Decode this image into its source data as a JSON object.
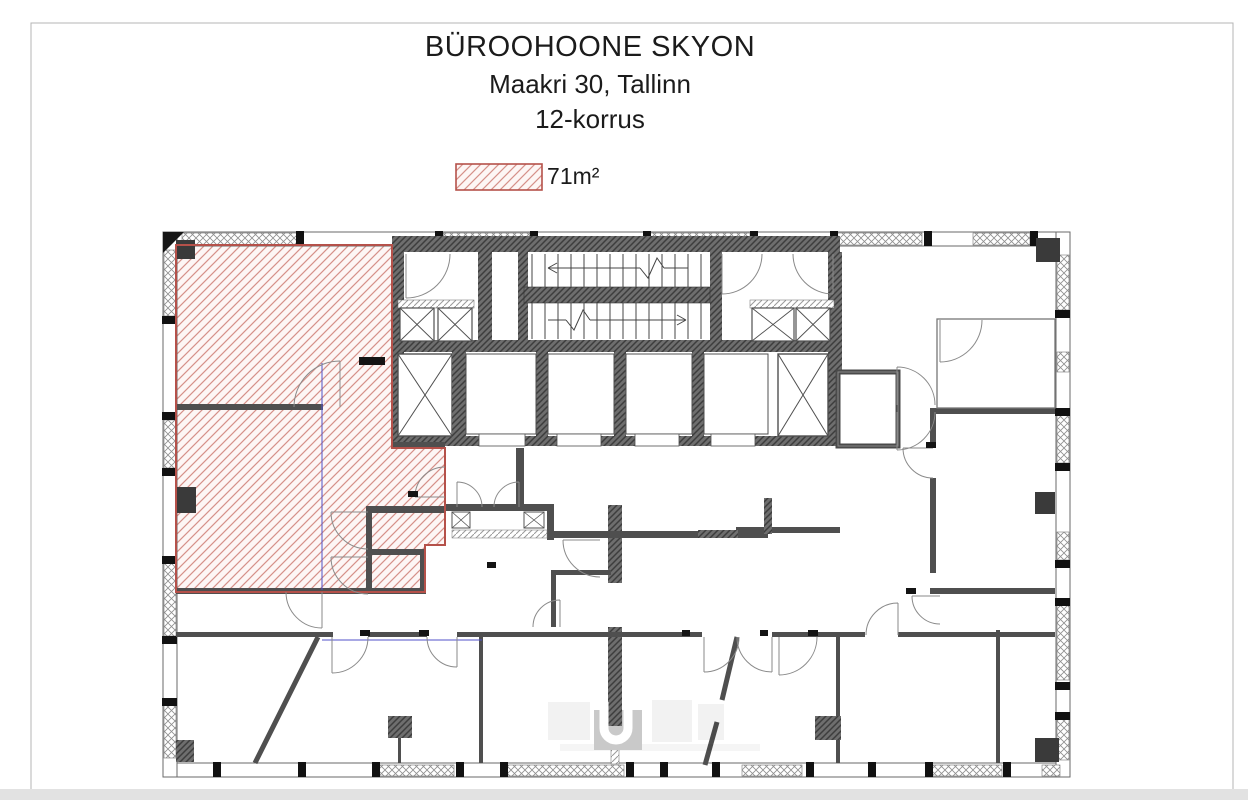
{
  "title": {
    "line1": "BÜROOHOONE SKYON",
    "line2": "Maakri 30, Tallinn",
    "line3": "12-korrus"
  },
  "legend": {
    "label": "Üüripind 71m²"
  },
  "floor_plan": {
    "building": "BÜROOHOONE SKYON",
    "address": "Maakri 30, Tallinn",
    "floor_label": "12-korrus",
    "leased_area_label": "Üüripind 71m²"
  },
  "colors": {
    "lease_red": "#b5514a",
    "lease_hatch_line": "#d59089",
    "wall_gray": "#4f4f4f",
    "mesh_gray": "#8f8f8f",
    "demising_blue": "#5050c8",
    "frame_gray": "#b4b4b4",
    "watermark_gray": "#c9c9c9",
    "text_black": "#1b1b1b"
  }
}
